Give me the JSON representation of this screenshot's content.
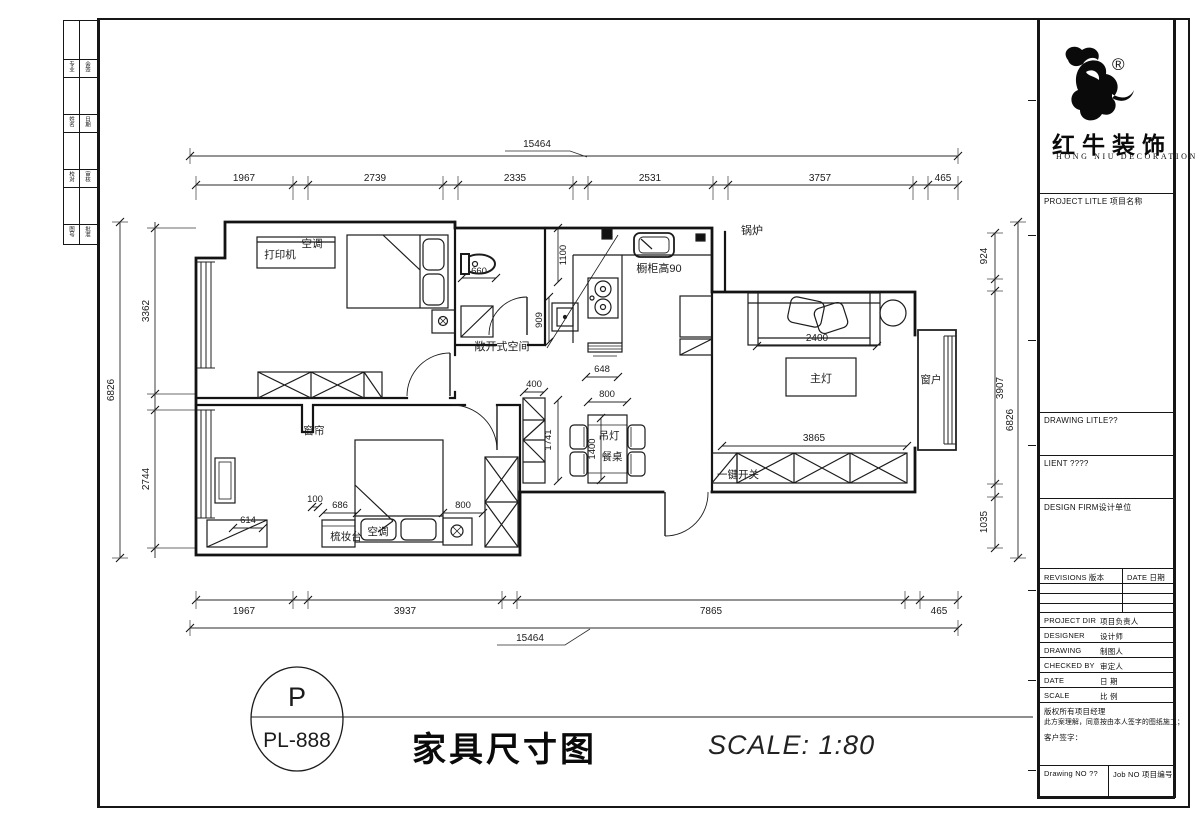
{
  "sheet": {
    "side_strip_rows": [
      [
        "专业",
        "会签"
      ],
      [
        "姓名",
        "日期"
      ],
      [
        "校对",
        "审核"
      ],
      [
        "图号",
        "批准"
      ]
    ]
  },
  "stamp": {
    "letter": "P",
    "code": "PL-888"
  },
  "titles": {
    "drawing_title": "家具尺寸图",
    "scale_note": "SCALE: 1:80"
  },
  "title_block": {
    "brand_cn": "红牛装饰",
    "brand_en": "HONG NIU DECORATION",
    "reg_mark": "®",
    "project_title": "PROJECT LITLE 项目名称",
    "drawing_title_row": "DRAWING LITLE??",
    "client_row": "LIENT ????",
    "design_firm_row": "DESIGN FIRM设计单位",
    "revisions_header": "REVISIONS 版本",
    "revisions_date_header": "DATE 日期",
    "project_dir": "PROJECT DIR",
    "project_dir_cn": "项目负责人",
    "designer": "DESIGNER",
    "designer_cn": "设计师",
    "drawing": "DRAWING",
    "drawing_cn": "制图人",
    "checked": "CHECKED BY",
    "checked_cn": "审定人",
    "date": "DATE",
    "date_cn": "日 期",
    "scale": "SCALE",
    "scale_cn": "比 例",
    "copyright1": "版权所有项目经理",
    "copyright2": "此方案理解，同意按由本人签字的图纸施工；",
    "copyright3": "客户签字：",
    "drawing_no": "Drawing NO ??",
    "job_no": "Job NO 项目编号"
  },
  "plan": {
    "dims": {
      "top_total": "15464",
      "bottom_total": "15464",
      "top_segments": [
        "1967",
        "2739",
        "2335",
        "2531",
        "3757",
        "465"
      ],
      "bottom_segments": [
        "1967",
        "3937",
        "7865",
        "465"
      ],
      "left_total": "6826",
      "left_segments": [
        "3362",
        "2744"
      ],
      "right_outer": "6826",
      "right_segments": [
        "924",
        "3907",
        "1035"
      ],
      "toilet": "660",
      "bath_wall": "1100",
      "basin": "909",
      "kitchen_opening": "648",
      "hall": "400",
      "dining_top": "800",
      "cabinet_col": "1741",
      "table_len": "1400",
      "sofa": "2400",
      "living": "3865",
      "b2_a": "100",
      "b2_b": "686",
      "b2_c": "614",
      "b2_d": "800"
    },
    "labels": {
      "printer": "打印机",
      "ac1": "空调",
      "open_space": "敞开式空间",
      "cabinet_h": "橱柜高90",
      "boiler": "锅炉",
      "main_light": "主灯",
      "window": "窗户",
      "curtain": "窗帘",
      "pendant": "吊灯",
      "dining_table": "餐桌",
      "dresser": "梳妆台",
      "ac2": "空调",
      "one_switch": "一键开关"
    }
  }
}
